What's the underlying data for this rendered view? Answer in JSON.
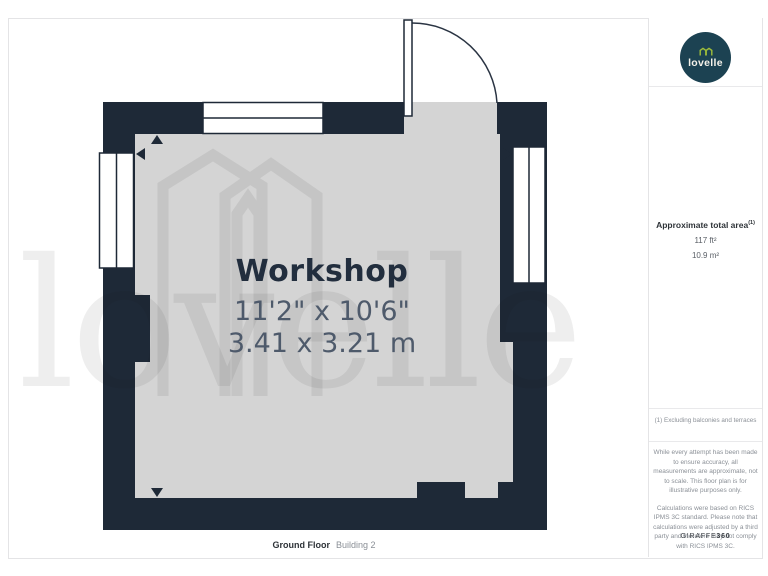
{
  "plan": {
    "room_label": "Workshop",
    "dimensions_imperial": "11'2\" x 10'6\"",
    "dimensions_metric": "3.41 x 3.21 m",
    "floor_label": "Ground Floor",
    "building_label": "Building 2",
    "watermark_text": "lovelle"
  },
  "sidebar": {
    "logo_text": "lovelle",
    "area": {
      "heading": "Approximate total area",
      "heading_superscript": "(1)",
      "imperial": "117 ft²",
      "metric": "10.9 m²"
    },
    "note": "(1) Excluding balconies and terraces",
    "disclaimer_1": "While every attempt has been made to ensure accuracy, all measurements are approximate, not to scale. This floor plan is for illustrative purposes only.",
    "disclaimer_2": "Calculations were based on RICS IPMS 3C standard. Please note that calculations were adjusted by a third party and therefore may not comply with RICS IPMS 3C.",
    "brand_name": "GIRAFFE",
    "brand_suffix": "360"
  },
  "colors": {
    "wall": "#1e2937",
    "room_fill": "#d4d4d4",
    "inner_watermark": "#c5c5c5",
    "logo_circle": "#1c4252",
    "logo_icon_green": "#9fbe3a",
    "dimension_text": "#4e5a6b"
  }
}
